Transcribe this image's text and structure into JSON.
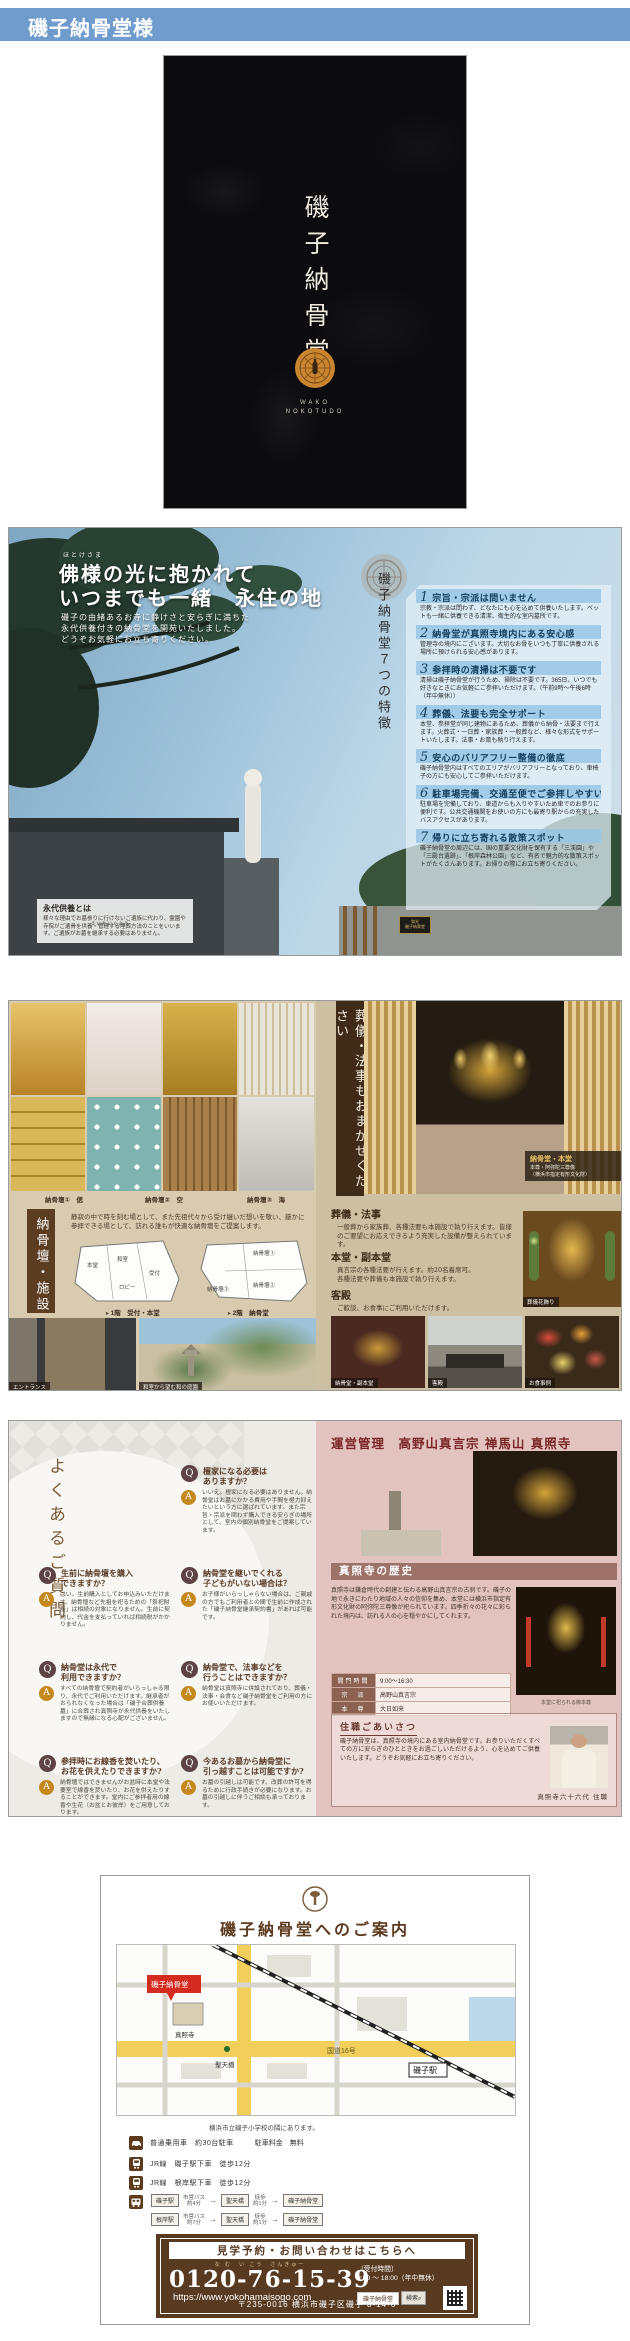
{
  "window": {
    "title": "磯子納骨堂様"
  },
  "cover": {
    "vertical_title": "磯子納骨堂",
    "roman_line1": "WAKO",
    "roman_line2": "NOKOTUDO"
  },
  "spread_features": {
    "left": {
      "furigana": "ほとけさま",
      "headline1": "佛様の光に抱かれて",
      "headline2": "いつまでも一緒　永住の地",
      "lead": "磯子の由緒あるお寺に静けさと安らぎに満ちた\n永代供養付きの納骨堂を開苑いたしました。\nどうぞお気軽にお立ち寄りください。",
      "eitai_furigana": "えいたいくよう",
      "eitai_title": "永代供養とは",
      "eitai_body": "様々な理由でお墓参りに行けないご遺族に代わり、霊園や寺院がご遺骨を供養・管理する埋葬方法のことをいいます。ご遺族がお墓を継承する必要はありません。"
    },
    "right": {
      "vertical_title": "磯子納骨堂７つの特徴",
      "sign_plaque": "和光\n磯子納骨堂",
      "features": [
        {
          "num": "1",
          "title": "宗旨・宗派は問いません",
          "desc": "宗教・宗派は問わず、どなたにも心を込めて供養いたします。ペットも一緒に供養できる清潔、衛生的な室内墓所です。"
        },
        {
          "num": "2",
          "title": "納骨堂が真照寺境内にある安心感",
          "desc": "管理寺の境内にございます。大切なお骨をいつも丁寧に供養される場所に預けられる安心感があります。"
        },
        {
          "num": "3",
          "title": "参拝時の清掃は不要です",
          "desc": "清掃は磯子納骨堂が行うため、掃除は不要です。365日、いつでも好きなときにお気軽にご参拝いただけます。（午前9時～午後6時（年中無休））"
        },
        {
          "num": "4",
          "title": "葬儀、法要も完全サポート",
          "desc": "本堂、参拝堂が同じ建物にあるため、葬儀から納骨・法要まで行えます。火葬式・一日葬・家族葬・一般葬など、様々な形式をサポートいたします。法事・お斎も執り行えます。"
        },
        {
          "num": "5",
          "title": "安心のバリアフリー整備の徹底",
          "desc": "磯子納骨堂内はすべてのエリアがバリアフリーとなっており、車椅子の方にも安心してご参拝いただけます。"
        },
        {
          "num": "6",
          "title": "駐車場完備、交通至便でご参拝しやすい立地",
          "desc": "駐車場を完備しており、車道からも入りやすいため車でのお参りに便利です。公共交通機関をお使いの方にも最寄り駅からの充実したバスアクセスがあります。"
        },
        {
          "num": "7",
          "title": "帰りに立ち寄れる散策スポット",
          "desc": "磯子納骨堂の周辺には、国の重要文化財を保有する「三渓園」や「三殿台遺跡」、「根岸森林公園」など、有名で魅力的な散策スポットがたくさんあります。お帰りの際にお立ち寄りください。"
        }
      ]
    }
  },
  "spread_facility": {
    "left": {
      "photo_labels": [
        "納骨壇①　偲",
        "納骨壇②　空",
        "納骨壇③　海"
      ],
      "vertical_title": "納骨壇・施設",
      "intro": "静寂の中で時を刻む場として、また先祖代々から受け継いだ想いを敬い、厳かに参拝できる場として、訪れる誰もが快適な納骨壇をご提案します。",
      "plan1_rooms": [
        "本堂",
        "和室",
        "ロビー",
        "受付"
      ],
      "plan2_rooms": [
        "納骨壇①",
        "納骨壇②",
        "納骨壇③"
      ],
      "floor1_caption": "1階　受付・本堂",
      "floor2_caption": "2階　納骨堂",
      "caption_entrance": "エントランス",
      "caption_garden": "和室から望む和の庭園"
    },
    "right": {
      "vertical_title": "葬儀・法事もおまかせください",
      "main_caption_title": "納骨堂・本堂",
      "main_caption_body": "本尊・阿弥陀三尊像\n（横浜市指定有形文化財）",
      "sections": [
        {
          "title": "葬儀・法事",
          "body": "一般葬から家族葬、各種法要も本施設で執り行えます。皆様のご要望にお応えできるよう充実した設備が整えられています。"
        },
        {
          "title": "本堂・副本堂",
          "body": "真言宗の各種法要が行えます。約20名着席可。\n各種法要や葬儀も本施設で執り行えます。"
        },
        {
          "title": "客殿",
          "body": "ご歓談、お食事にご利用いただけます。"
        }
      ],
      "photo_captions": {
        "flower": "葬儀花飾り",
        "sub_hall": "納骨堂・副本堂",
        "guest_hall": "客殿",
        "meal": "お食事例"
      }
    }
  },
  "spread_faq_temple": {
    "faq": {
      "vertical_title": "よくあるご質問",
      "items": [
        {
          "q": "檀家になる必要は\nありますか？",
          "a": "いいえ。檀家になる必要はありません。納骨堂はお墓にかかる費用や手間を極力抑えたいという方に選ばれています。また宗旨・宗派を問わず購入できる安らぎの場所として、室内の個別納骨堂をご提案しています。"
        },
        {
          "q": "生前に納骨壇を購入\nできますか？",
          "a": "はい。生前購入としてお申込みいただけます。納骨壇など先祖を祀るための「祭祀財産」は相続の対象になりません。生前に契約し、代金を支払っていれば相続税がかかりません。"
        },
        {
          "q": "納骨堂を継いでくれる\n子どもがいない場合は？",
          "a": "お子様がいらっしゃらない場合は、ご親戚の方でもご利用者との間で生前に作成された「磯子納骨堂継承契約書」があれば可能です。"
        },
        {
          "q": "納骨堂は永代で\n利用できますか？",
          "a": "すべての納骨壇で契約者がいらっしゃる限り、永代でご利用いただけます。継承者がおられなくなった場合は「磯子合葬供養墓」に合葬され真照寺が永代供養をいたしますので無縁になる心配がございません。"
        },
        {
          "q": "納骨堂で、法事などを\n行うことはできますか？",
          "a": "納骨堂は真照寺に併設されており、葬儀・法事・会食など磯子納骨堂をご利用の方にお使いいただけます。"
        },
        {
          "q": "参拝時にお線香を焚いたり、\nお花を供えたりできますか?",
          "a": "納骨壇ではできませんがお盆時に本堂や法要室で線香を焚いたり、お花を供えたりすることができます。堂内にご参拝者用の線香や生花（お盆とお彼岸）をご用意しております。"
        },
        {
          "q": "今あるお墓から納骨堂に\n引っ越すことは可能ですか?",
          "a": "お墓の引越しは可能です。改葬の許可を得るために行政手続きが必要になります。お墓の引越しに伴うご相談も承っております。"
        }
      ]
    },
    "temple": {
      "title": "運営管理　高野山真言宗 禅馬山 真照寺",
      "history_title": "真照寺の歴史",
      "history_body": "真照寺は鎌倉時代の創建と伝わる高野山真言宗の古刹です。磯子の地で永きにわたり地域の人々の信仰を集め、本堂には横浜市指定有形文化財の阿弥陀三尊像が祀られています。四季折々の花々に彩られた境内は、訪れる人の心を穏やかにしてくれます。",
      "table": [
        {
          "label": "開門時間",
          "value": "9:00～16:30"
        },
        {
          "label": "宗　派",
          "value": "高野山真言宗"
        },
        {
          "label": "本　尊",
          "value": "大日如来"
        }
      ],
      "photo_caption": "本堂に祀られる御本尊",
      "greeting_title": "住職ごあいさつ",
      "greeting_body": "磯子納骨堂は、真照寺の境内にある室内納骨堂です。お参りいただくすべての方に安らぎのひとときをお過ごしいただけるよう、心を込めてご供養いたします。どうぞお気軽にお立ち寄りください。",
      "signature": "真照寺六十六代 住職"
    }
  },
  "access": {
    "title": "磯子納骨堂へのご案内",
    "map": {
      "badge": "磯子納骨堂",
      "temple": "真照寺",
      "bus_stop": "聖天橋",
      "station": "磯子駅",
      "road": "国道16号"
    },
    "map_caption": "横浜市立磯子小学校の隣にあります。",
    "transport": {
      "car_line1": "普通乗用車　約30台駐車",
      "car_line2": "駐車料金　無料",
      "train_line1": "JR線　磯子駅下車　徒歩12分",
      "train_line2": "JR線　根岸駅下車　徒歩12分",
      "route1": {
        "from": "磯子駅",
        "leg1": "市営バス\n約4分",
        "mid": "聖天橋",
        "leg2": "徒歩\n約1分",
        "to": "磯子納骨堂"
      },
      "route2": {
        "from": "根岸駅",
        "leg1": "市営バス\n約7分",
        "mid": "聖天橋",
        "leg2": "徒歩\n約1分",
        "to": "磯子納骨堂"
      }
    },
    "contact": {
      "banner": "見学予約・お問い合わせはこちらへ",
      "phone_furigana": "な む　い こう　さんきゅー",
      "phone": "0120-76-15-39",
      "hours_label": "〔受付時間〕",
      "hours": "9:00 ～ 18:00（年中無休）",
      "url": "https://www.yokohamaisogo.com",
      "search_word": "磯子納骨堂",
      "search_button": "検索",
      "address": "〒235-0016 横浜市磯子区磯子 8-14-6"
    }
  },
  "colors": {
    "header": "#6f9ccd",
    "brand_brown": "#5c3a1e",
    "accent_gold": "#c4881c",
    "q_circle": "#5d4343",
    "pink_page": "#e3c3bf"
  }
}
